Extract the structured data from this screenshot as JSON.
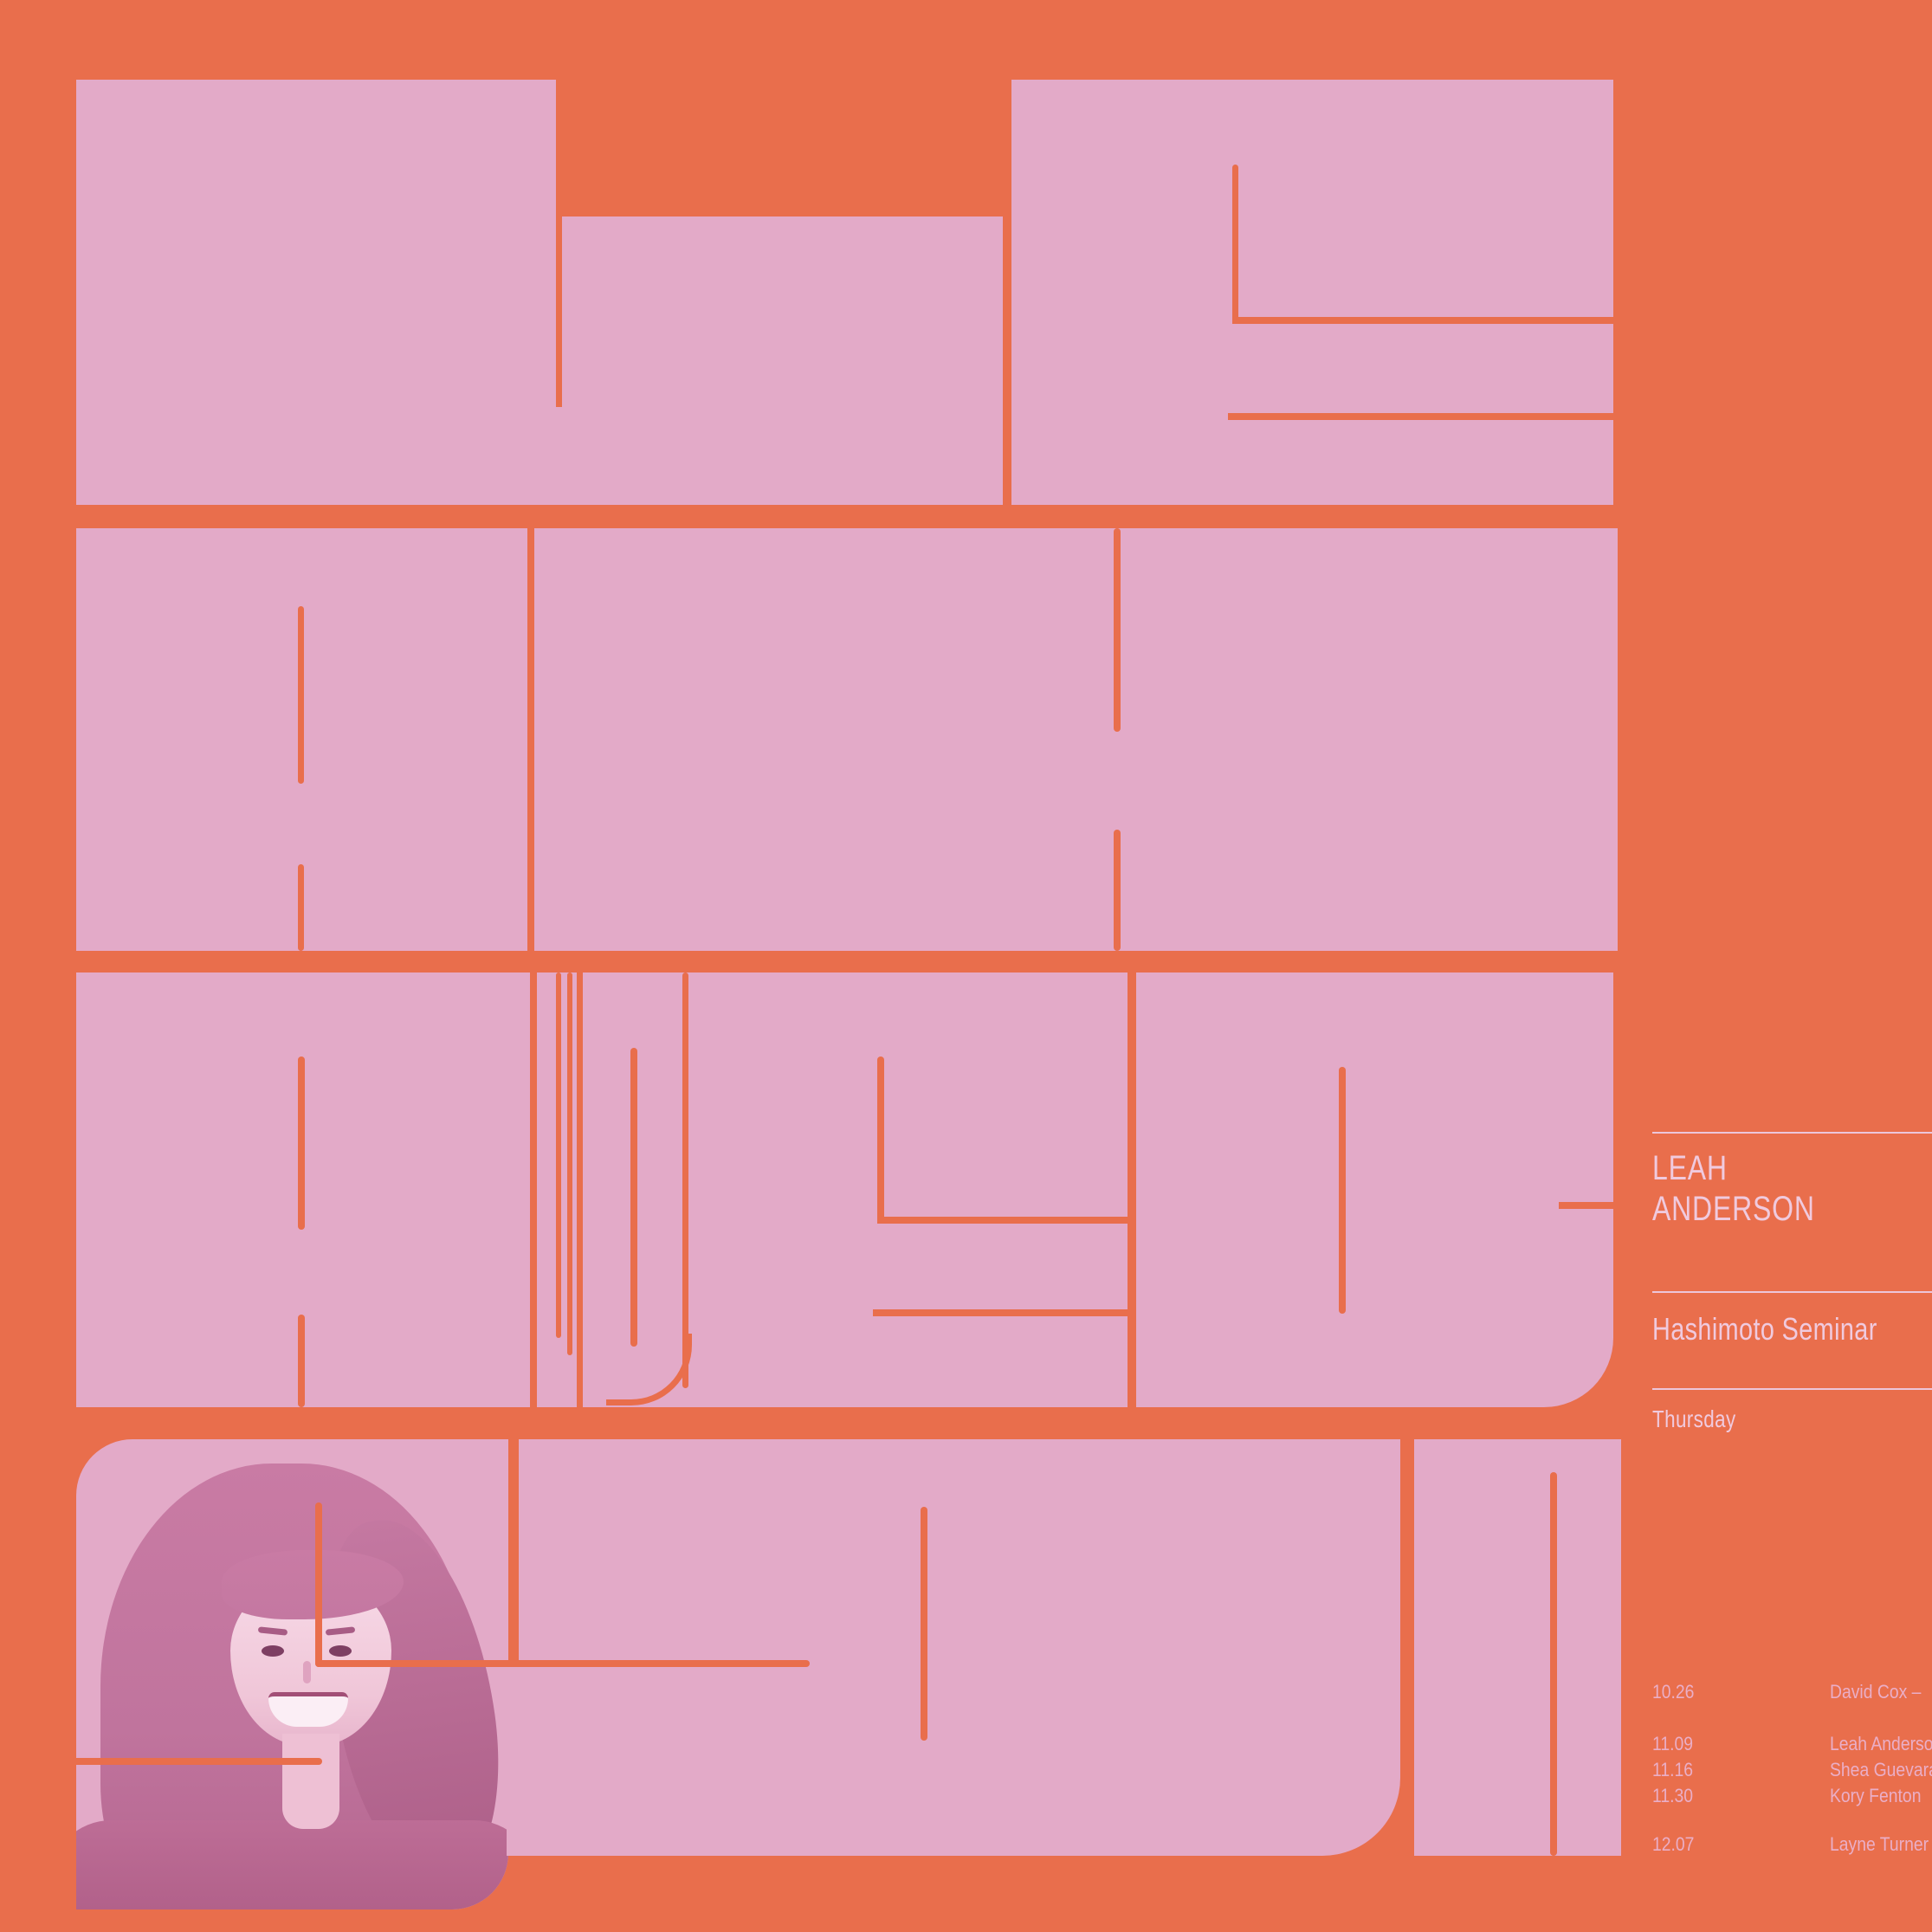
{
  "poster": {
    "title": "LEAH ANDERSON",
    "bg_color": "#e96e4c",
    "block_color": "#e3aac8",
    "text_color": "#f0cade",
    "rule_color": "#ecc6da",
    "schedule_text_color": "#eaaec7",
    "speaker_photo": "portrait-smiling-woman-long-dark-hair-duotone-pink"
  },
  "sidebar": {
    "name_line1": "LEAH",
    "name_line2": "ANDERSON",
    "event": "Hashimoto Seminar",
    "day": "Thursday"
  },
  "schedule": {
    "items": [
      {
        "date": "10.26",
        "name": "David Cox –"
      },
      {
        "date": "11.09",
        "name": "Leah Anderson"
      },
      {
        "date": "11.16",
        "name": "Shea Guevara"
      },
      {
        "date": "11.30",
        "name": "Kory Fenton"
      },
      {
        "date": "12.07",
        "name": "Layne Turner"
      }
    ]
  }
}
